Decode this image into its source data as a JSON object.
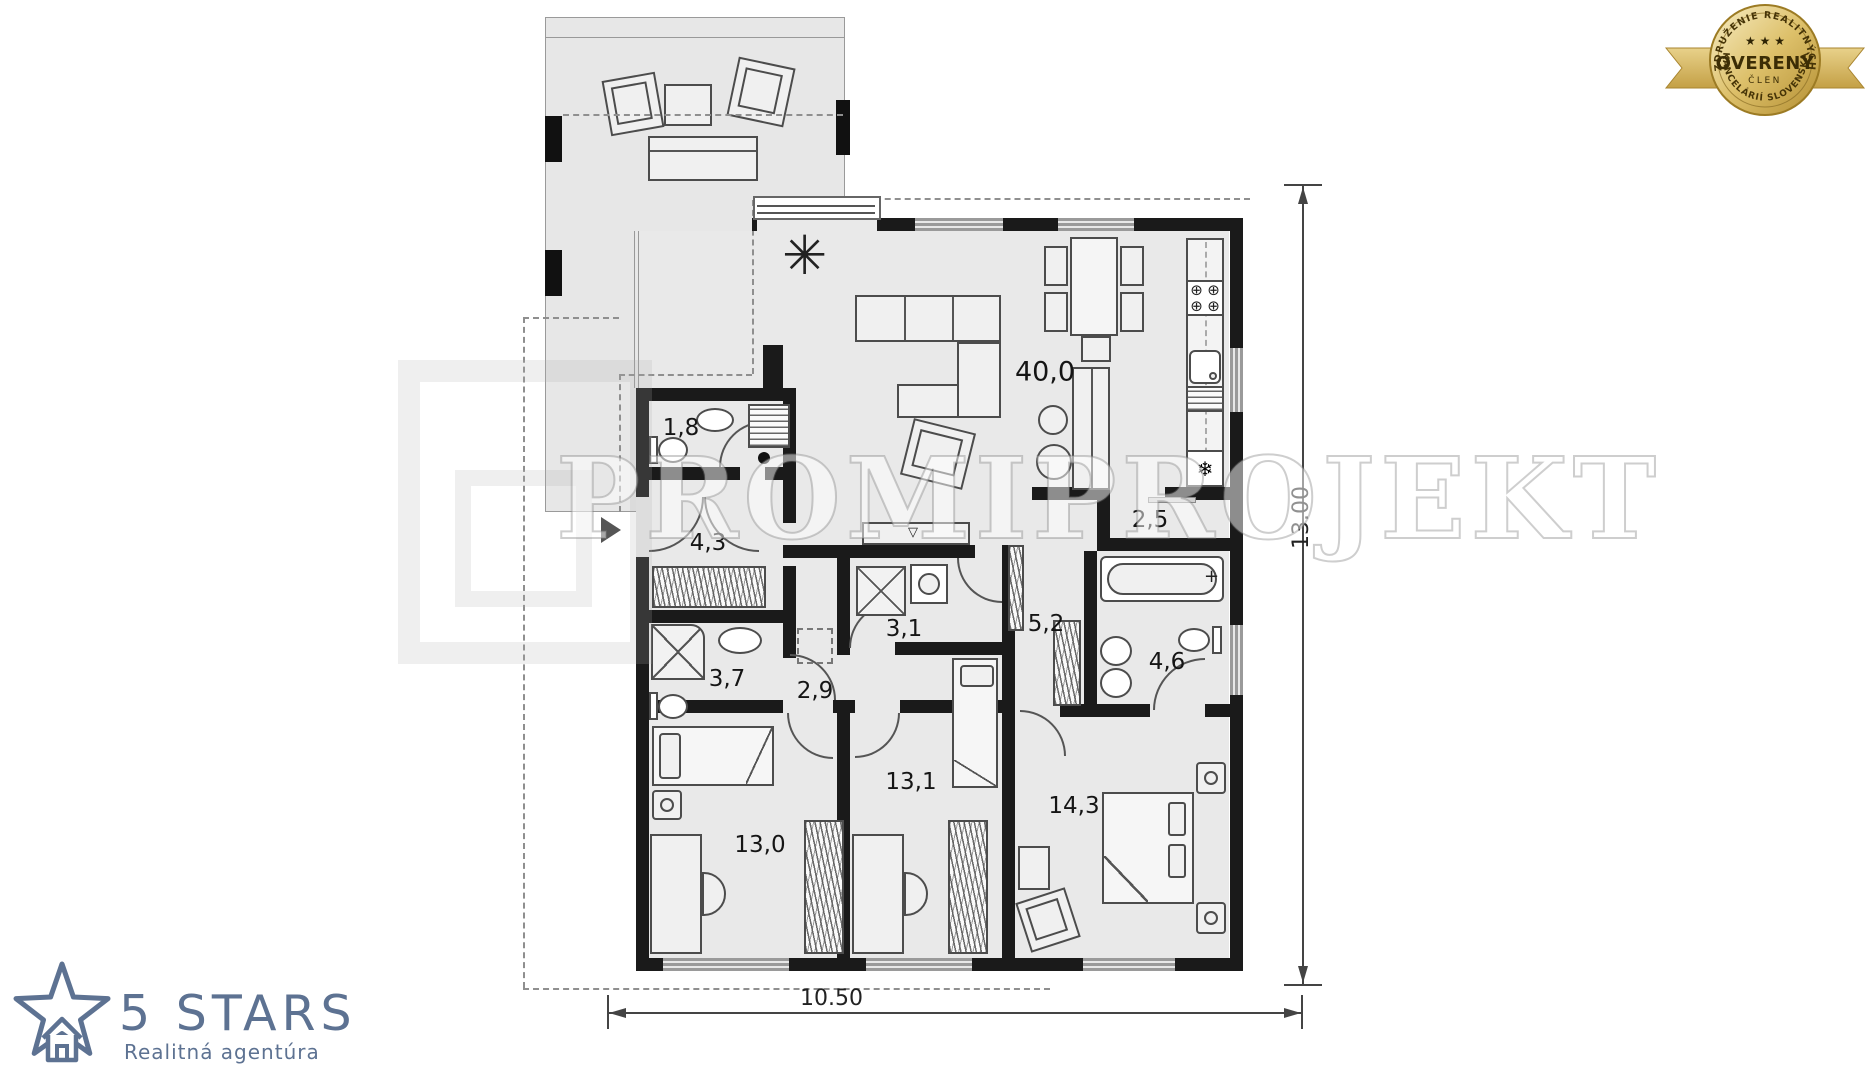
{
  "plan": {
    "rooms": [
      {
        "id": "living-kitchen",
        "label": "40,0"
      },
      {
        "id": "wc",
        "label": "1,8"
      },
      {
        "id": "entry-hall",
        "label": "4,3"
      },
      {
        "id": "bathroom-shower",
        "label": "3,7"
      },
      {
        "id": "inner-hall",
        "label": "2,9"
      },
      {
        "id": "laundry-shower",
        "label": "3,1"
      },
      {
        "id": "pantry",
        "label": "2,5"
      },
      {
        "id": "corridor",
        "label": "5,2"
      },
      {
        "id": "bathroom-tub",
        "label": "4,6"
      },
      {
        "id": "bedroom-left",
        "label": "13,0"
      },
      {
        "id": "bedroom-middle",
        "label": "13,1"
      },
      {
        "id": "bedroom-master",
        "label": "14,3"
      }
    ],
    "dimensions": {
      "width_m": "10.50",
      "height_m": "13.00"
    }
  },
  "watermark": {
    "text": "PROMIPROJEKT"
  },
  "badge": {
    "arc_top": "ZDRUŽENIE REALITNÝCH",
    "title": "OVERENÝ",
    "subtitle": "ČLEN",
    "arc_bottom": "KANCELÁRIÍ SLOVENSKA",
    "stars": "★ ★ ★",
    "gold": "#c9a43c"
  },
  "agency": {
    "name": "5 STARS",
    "tagline": "Realitná agentúra",
    "color": "#5d7292"
  },
  "icons": {
    "burner": "⊕",
    "snowflake": "❄",
    "plant": "✳",
    "tv": "▽",
    "tap": "+"
  }
}
